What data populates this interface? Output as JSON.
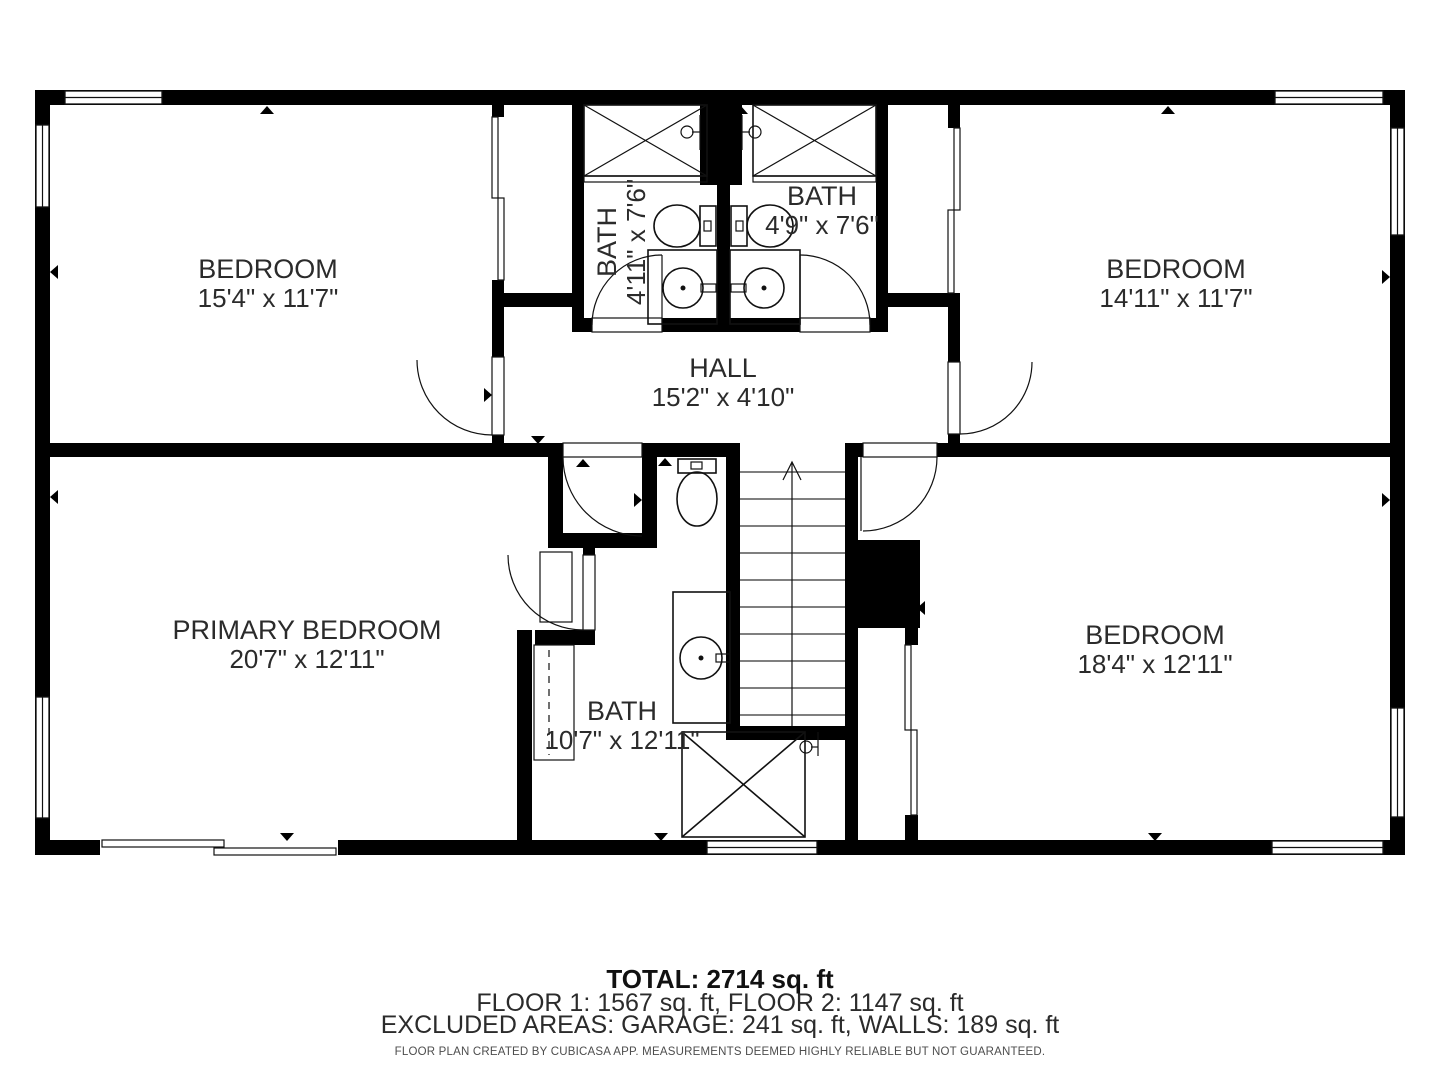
{
  "colors": {
    "wall": "#000000",
    "text": "#2b2b2b",
    "fixture_stroke": "#111111",
    "disclaimer": "#4d4d4d",
    "background": "#ffffff"
  },
  "rooms": {
    "bedroom_tl": {
      "name": "BEDROOM",
      "dims": "15'4\" x 11'7\""
    },
    "bath_tl": {
      "name": "BATH",
      "dims": "4'11\" x 7'6\""
    },
    "bath_tr": {
      "name": "BATH",
      "dims": "4'9\" x 7'6\""
    },
    "bedroom_tr": {
      "name": "BEDROOM",
      "dims": "14'11\" x 11'7\""
    },
    "hall": {
      "name": "HALL",
      "dims": "15'2\" x 4'10\""
    },
    "primary": {
      "name": "PRIMARY BEDROOM",
      "dims": "20'7\" x 12'11\""
    },
    "bath_b": {
      "name": "BATH",
      "dims": "10'7\" x 12'11\""
    },
    "bedroom_br": {
      "name": "BEDROOM",
      "dims": "18'4\" x 12'11\""
    }
  },
  "footer": {
    "total": "TOTAL: 2714 sq. ft",
    "floors": "FLOOR 1: 1567 sq. ft, FLOOR 2: 1147 sq. ft",
    "excluded": "EXCLUDED AREAS: GARAGE: 241 sq. ft, WALLS: 189 sq. ft",
    "disclaimer": "FLOOR PLAN CREATED BY CUBICASA APP. MEASUREMENTS DEEMED HIGHLY RELIABLE BUT NOT GUARANTEED."
  }
}
